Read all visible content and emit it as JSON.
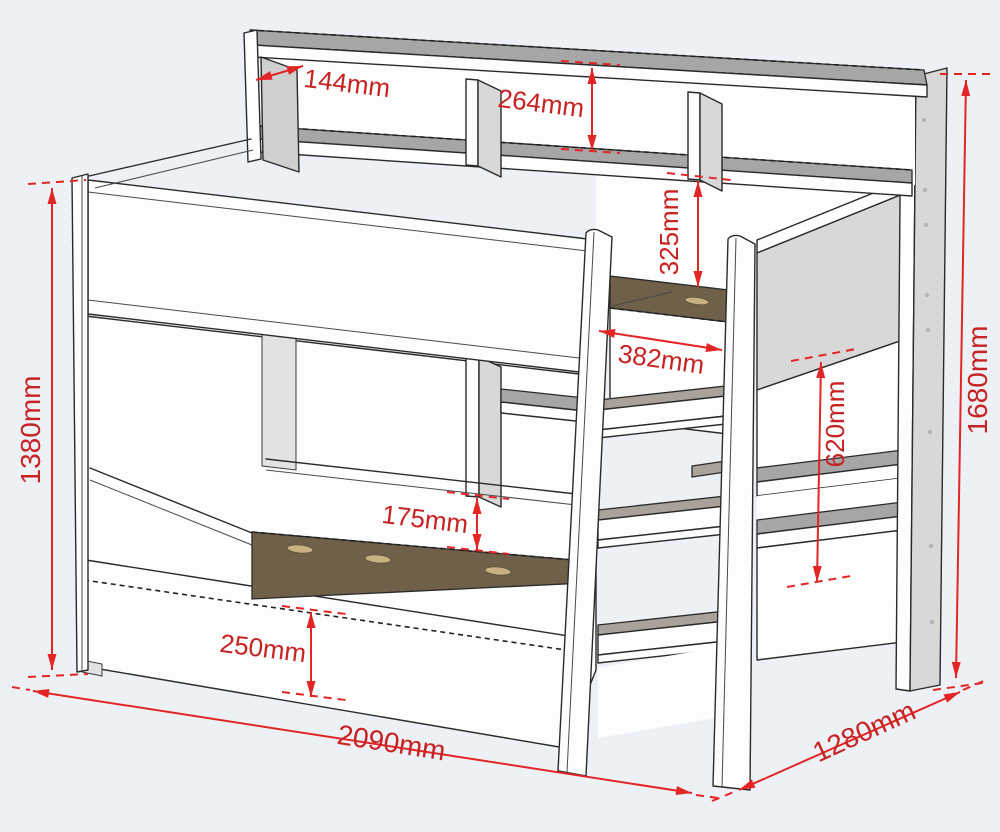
{
  "diagram_type": "bunk-bed-dimension-drawing",
  "dimensions": {
    "shelf_depth": {
      "label": "144mm"
    },
    "shelf_height": {
      "label": "264mm"
    },
    "rail_above_mattress": {
      "label": "325mm"
    },
    "ladder_width": {
      "label": "382mm"
    },
    "shelf_gap": {
      "label": "620mm"
    },
    "lower_rail_height": {
      "label": "175mm"
    },
    "drawer_height": {
      "label": "250mm"
    },
    "left_height": {
      "label": "1380mm"
    },
    "right_height": {
      "label": "1680mm"
    },
    "length": {
      "label": "2090mm"
    },
    "depth": {
      "label": "1280mm"
    }
  },
  "colors": {
    "dimension_text": "#c82323",
    "dimension_line": "#e32525",
    "background": "#edf1f6",
    "wood_brown": "#6e6049",
    "panel_gray": "#d8d8d8",
    "surface_gray": "#a6a6a6"
  }
}
